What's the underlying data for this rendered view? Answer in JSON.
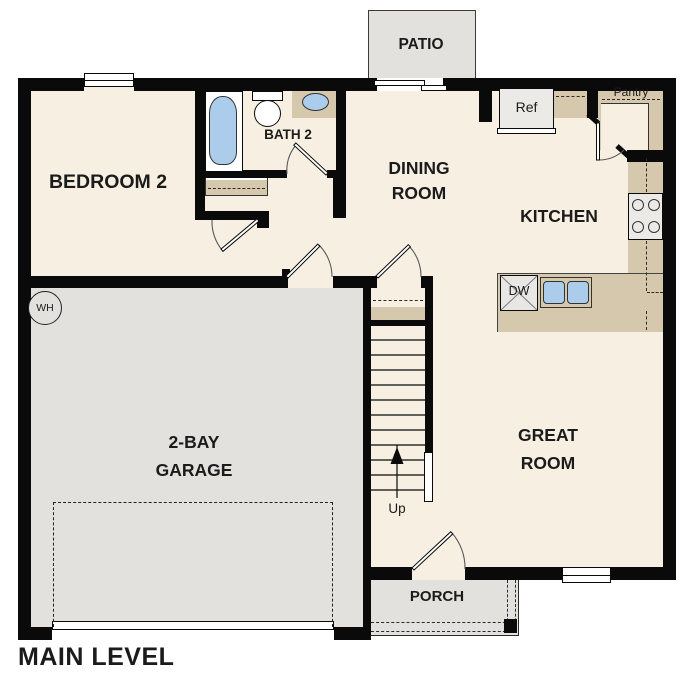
{
  "plan": {
    "title": "MAIN LEVEL",
    "rooms": {
      "patio": "PATIO",
      "bedroom2": "BEDROOM 2",
      "bath2": "BATH 2",
      "dining_line1": "DINING",
      "dining_line2": "ROOM",
      "kitchen": "KITCHEN",
      "great_line1": "GREAT",
      "great_line2": "ROOM",
      "garage_line1": "2-BAY",
      "garage_line2": "GARAGE",
      "porch": "PORCH"
    },
    "labels": {
      "ref": "Ref",
      "pantry": "Pantry",
      "dw": "DW",
      "wh": "WH",
      "up": "Up"
    },
    "colors": {
      "floor_cream": "#f7f0e2",
      "outdoor_gray": "#e2e1de",
      "counter_tan": "#d5c8ad",
      "fixture_blue": "#abcdeb",
      "wall_black": "#0a0a0a"
    }
  }
}
